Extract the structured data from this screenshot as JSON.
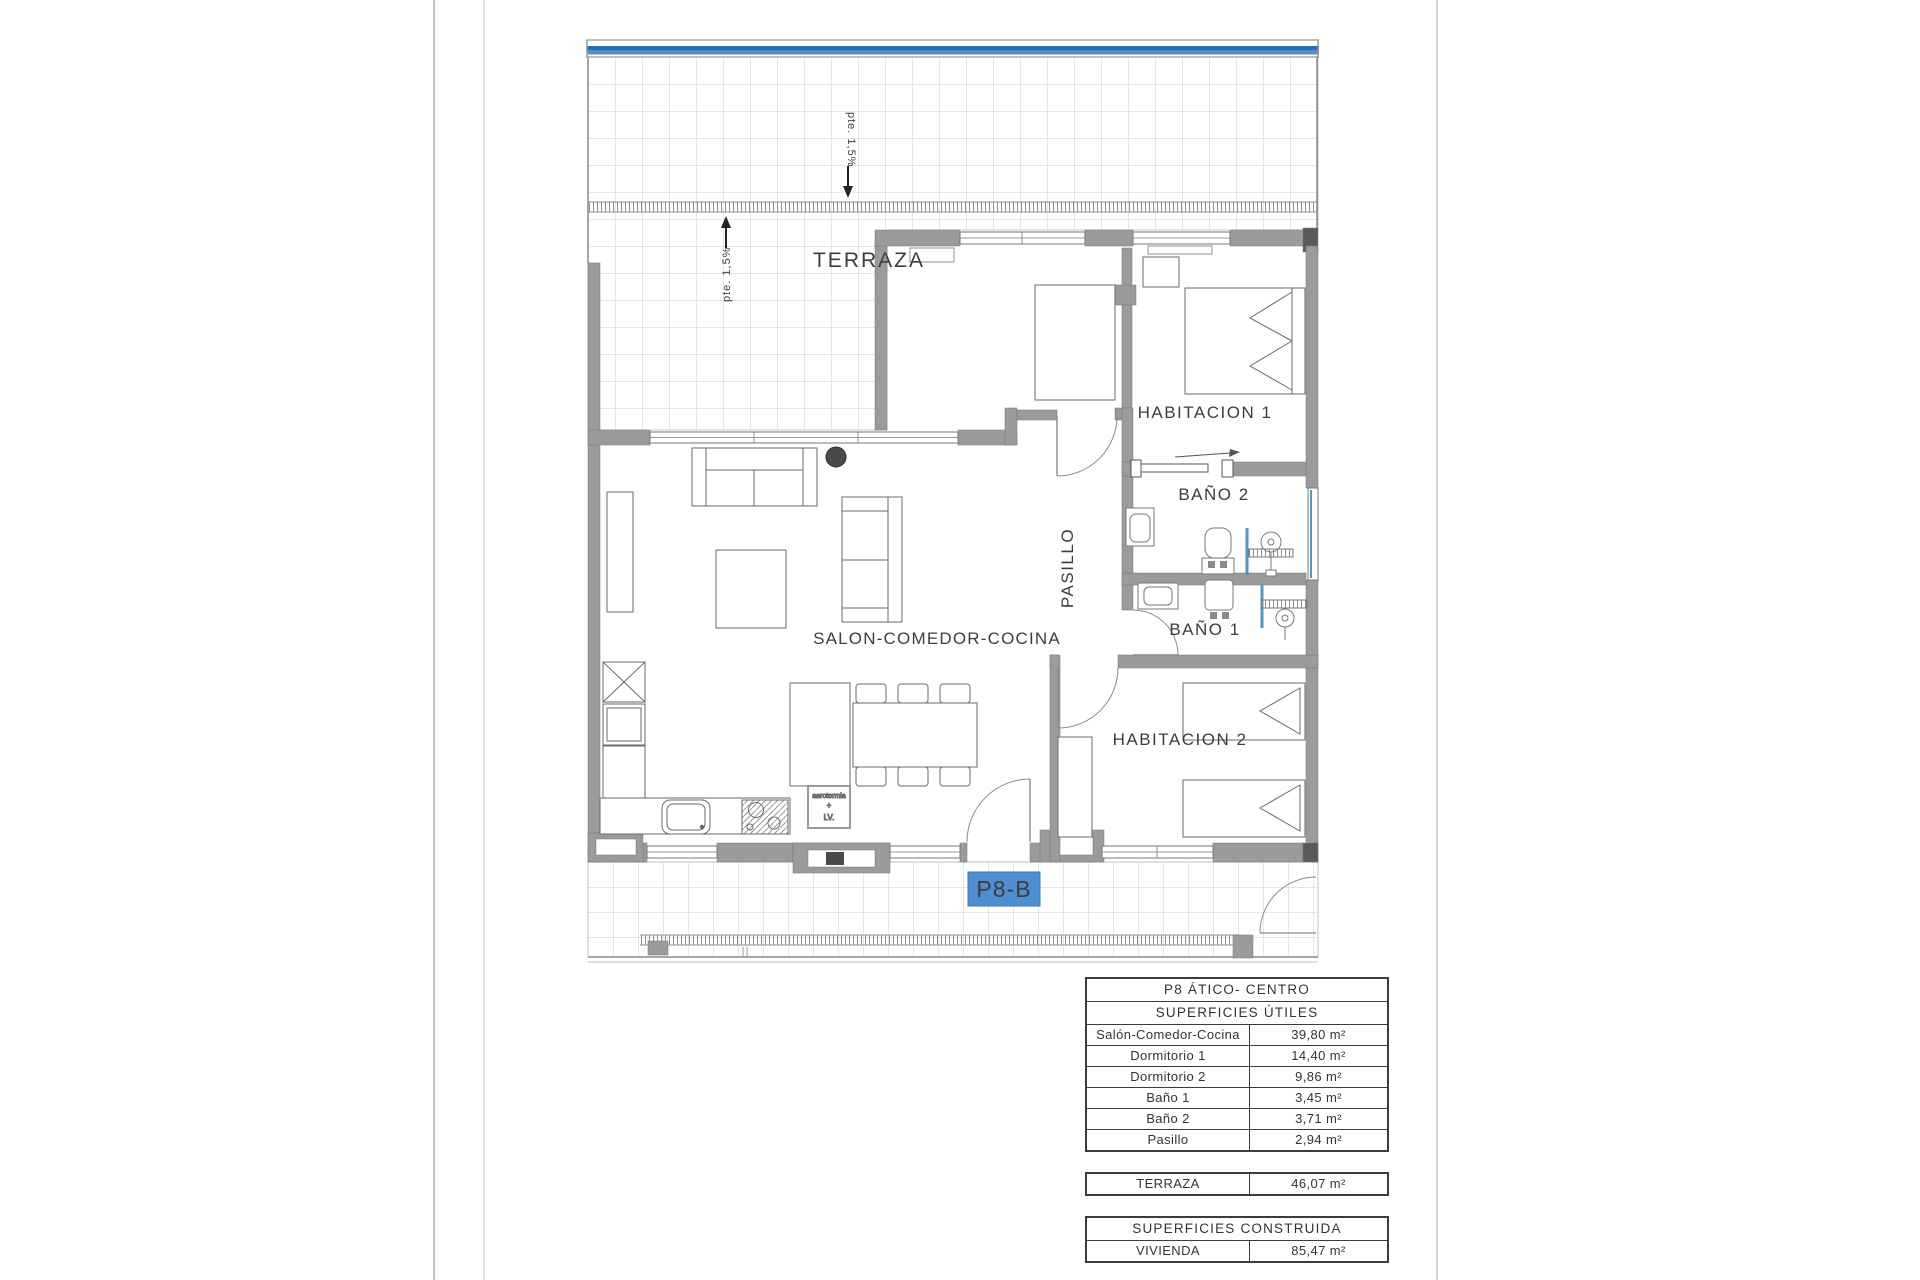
{
  "plan": {
    "labels": {
      "terraza": "TERRAZA",
      "habitacion1": "HABITACION 1",
      "bano2": "BAÑO 2",
      "pasillo": "PASILLO",
      "bano1": "BAÑO 1",
      "salon": "SALON-COMEDOR-COCINA",
      "habitacion2": "HABITACION 2",
      "slope_top": "pte. 1,5%",
      "slope_terrace": "pte. 1,5%",
      "unit_badge": "P8-B",
      "appliance_line1": "aerotermia",
      "appliance_line2": "+",
      "appliance_line3": "LV."
    },
    "colors": {
      "wall_grey": "#9b9b9b",
      "badge_blue": "#4d8fd1",
      "railing_blue_dark": "#2a6cae",
      "railing_blue_light": "#5191c8",
      "fixture_blue": "#4f97c9"
    }
  },
  "tables": {
    "useful": {
      "title": "P8 ÁTICO- CENTRO",
      "subtitle": "SUPERFICIES ÚTILES",
      "rows": [
        {
          "label": "Salón-Comedor-Cocina",
          "value": "39,80 m²"
        },
        {
          "label": "Dormitorio 1",
          "value": "14,40 m²"
        },
        {
          "label": "Dormitorio 2",
          "value": "9,86 m²"
        },
        {
          "label": "Baño 1",
          "value": "3,45 m²"
        },
        {
          "label": "Baño 2",
          "value": "3,71 m²"
        },
        {
          "label": "Pasillo",
          "value": "2,94 m²"
        }
      ]
    },
    "terraza": {
      "label": "TERRAZA",
      "value": "46,07 m²"
    },
    "built": {
      "title": "SUPERFICIES CONSTRUIDA",
      "rows": [
        {
          "label": "VIVIENDA",
          "value": "85,47 m²"
        }
      ]
    }
  }
}
